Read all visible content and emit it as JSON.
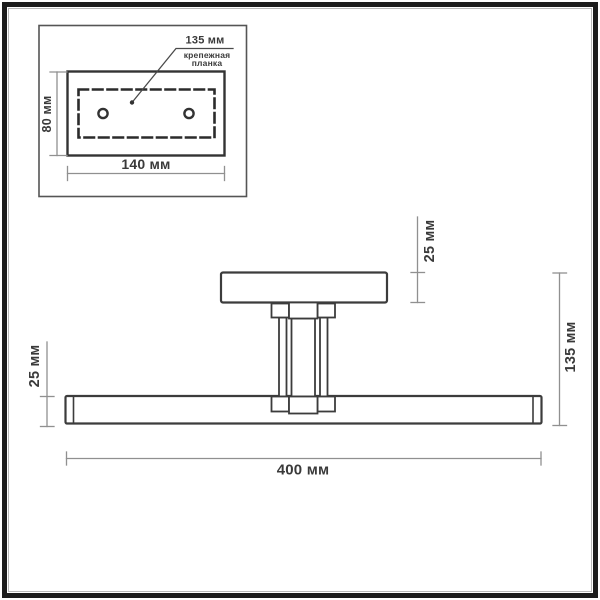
{
  "drawing": {
    "inset": {
      "hole_pitch_label": "135 мм",
      "plate_name_label": "крепежная\nпланка",
      "plate_height_label": "80 мм",
      "plate_width_label": "140 мм"
    },
    "front_view": {
      "canopy_height_label": "25 мм",
      "bar_height_label": "25 мм",
      "overall_height_label": "135 мм",
      "overall_width_label": "400 мм"
    },
    "colors": {
      "frame": "#1c1c1c",
      "object_line": "#3c3c3c",
      "dimension_line": "#909090",
      "text": "#3a3a3a",
      "background": "#ffffff"
    }
  }
}
